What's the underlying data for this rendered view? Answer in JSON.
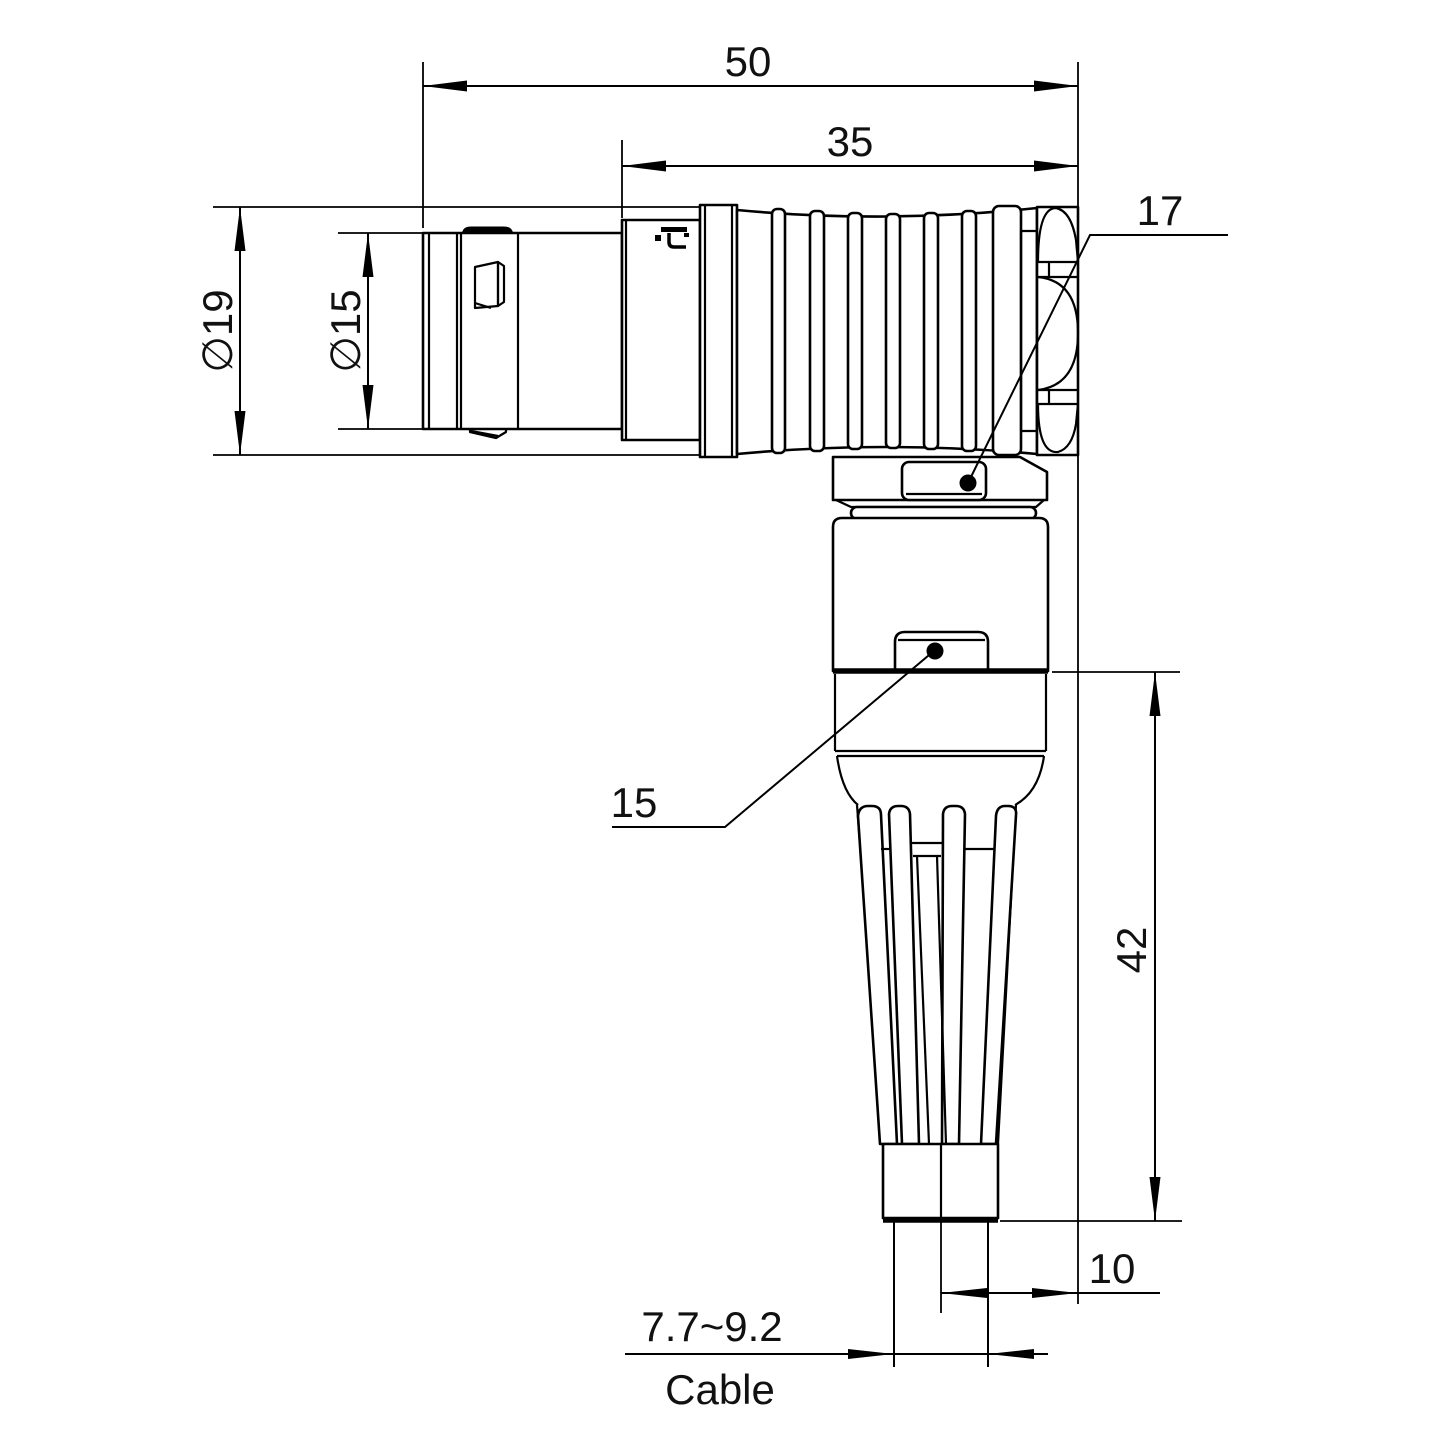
{
  "page": {
    "background": "#ffffff",
    "line_color": "#000000"
  },
  "watermark": {
    "text": "Lightany",
    "color": "#f6b8b8"
  },
  "dimensions": {
    "overall_length": "50",
    "rear_body_length": "35",
    "shell_diameter": "∅19",
    "front_diameter": "∅15",
    "hex_nut_size": "17",
    "elbow_nut_size": "15",
    "vertical_length": "42",
    "axis_to_face_offset": "10",
    "cable_diameter_range": "7.7~9.2",
    "cable_label": "Cable"
  }
}
